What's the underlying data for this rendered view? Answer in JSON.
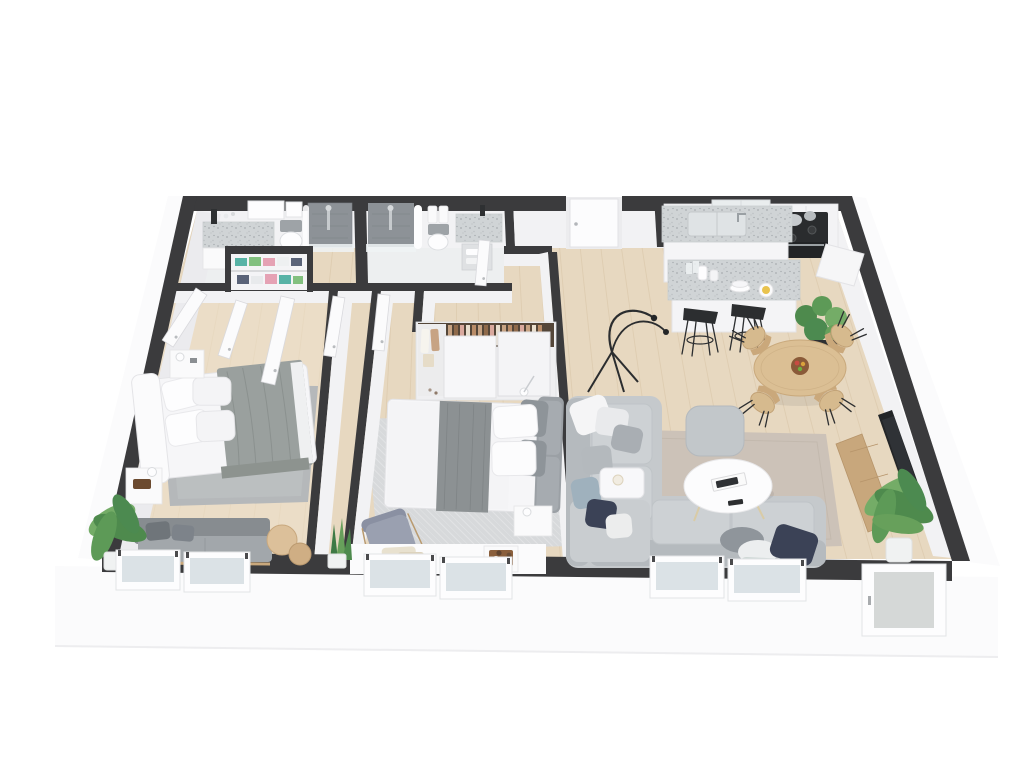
{
  "scene": {
    "type": "3d-floorplan-render",
    "view": "top-down axonometric cutaway of a two-bedroom apartment",
    "background": "#ffffff"
  },
  "colors": {
    "wall_top": "#3b3b3d",
    "wall_face": "#f2f2f4",
    "wall_face_shade": "#ebebee",
    "fascia": "#fbfbfc",
    "fascia_edge": "#ededef",
    "wood": "#e7d8c0",
    "wood_line": "#cdb795",
    "bath_floor": "#edeff0",
    "tile": "#8d9297",
    "tile_dark": "#75797e",
    "glass": "#dbe2e6",
    "white_furn": "#fafafb",
    "terrazzo_base": "#d0d4d6",
    "terrazzo_dot": "#a8adb1",
    "rug_master": "#b5b8ba",
    "rug_bedroom": "#d7d9db",
    "rug_living": "#ccc2b8",
    "sofa": "#c5c9cc",
    "sofa_cushion": "#cdd1d4",
    "sofa_shade": "#b5babe",
    "pillow_gray": "#a9aeb3",
    "navy": "#3b4256",
    "seafoam": "#cfd8d6",
    "bed_white": "#f6f6f8",
    "blanket": "#9aa09e",
    "headboard": "#9ba0a5",
    "runner": "#8c9193",
    "wood_table": "#dbbf94",
    "wood_chair": "#d6ba8e",
    "wood_tv": "#c8a77c",
    "plant": "#4e8a4d",
    "plant_light": "#74ac67",
    "pot_dark": "#2e3032",
    "pot_white": "#f0f2f2",
    "stove": "#2a2c2e",
    "metal": "#c6cacd",
    "stool": "#2c2e30",
    "door": "#fbfbfc",
    "door_edge": "#d9d9dd",
    "shadow": "rgba(70,70,80,0.10)",
    "linen_teal": "#58b3a6",
    "linen_green": "#82c07f",
    "linen_pink": "#e5a2b4",
    "linen_navy": "#5a6378",
    "clothes_tan": "#c7a383",
    "clothes_brown": "#8f6a4b",
    "clothes_blush": "#d9a99e",
    "clothes_cream": "#e9dfcf",
    "armchair": "#9aa0b0",
    "tray_brown": "#8a5f3c"
  },
  "rooms": [
    {
      "id": "master-bedroom",
      "label": "master bedroom",
      "furniture": [
        "double-bed",
        "headboard",
        "pillows",
        "gray-blanket",
        "area-rug",
        "nightstand-with-lamp",
        "nightstand-with-tray",
        "bench-sofa",
        "round-side-tables",
        "palm-plant"
      ]
    },
    {
      "id": "master-bathroom",
      "label": "en-suite bathroom",
      "furniture": [
        "terrazzo-vanity",
        "mirror",
        "black-vase",
        "toilet",
        "walk-in-shower"
      ]
    },
    {
      "id": "linen-closet",
      "label": "linen closet",
      "furniture": [
        "shelves",
        "folded-linens",
        "double-doors"
      ]
    },
    {
      "id": "second-bathroom",
      "label": "bathroom",
      "furniture": [
        "walk-in-shower",
        "shower-curtain",
        "hanging-towels",
        "toilet",
        "terrazzo-vanity",
        "towel-shelf"
      ]
    },
    {
      "id": "hallway",
      "label": "hallway",
      "furniture": [
        "open-doors"
      ]
    },
    {
      "id": "walk-in-closet",
      "label": "walk-in closet",
      "furniture": [
        "sliding-door-wardrobe",
        "hanging-clothes",
        "tote-bag"
      ]
    },
    {
      "id": "second-bedroom",
      "label": "bedroom",
      "furniture": [
        "double-bed",
        "upholstered-headboard",
        "bed-runner",
        "patterned-rug",
        "nightstand-with-lamp",
        "armchair",
        "window-bench",
        "cushions",
        "tray-with-jars",
        "snake-plant"
      ]
    },
    {
      "id": "kitchen",
      "label": "kitchen",
      "furniture": [
        "wall-cabinets",
        "canisters",
        "gas-range",
        "pots",
        "oven",
        "sink-island",
        "breakfast-bar",
        "dishes",
        "bar-stools"
      ]
    },
    {
      "id": "dining-area",
      "label": "dining area",
      "furniture": [
        "round-dining-table",
        "fruit-bowl",
        "dining-chairs",
        "fiddle-leaf-plant",
        "arc-floor-lamp"
      ]
    },
    {
      "id": "living-room",
      "label": "living room",
      "furniture": [
        "corner-sectional-sofa",
        "throw-pillows",
        "ottoman",
        "round-coffee-table",
        "books",
        "remote",
        "side-table",
        "candle",
        "area-rug",
        "tv-console",
        "television",
        "palm-plant"
      ]
    },
    {
      "id": "exterior",
      "label": "exterior envelope",
      "furniture": [
        "entry-door",
        "patio-door",
        "windows",
        "front-fascia"
      ]
    }
  ]
}
